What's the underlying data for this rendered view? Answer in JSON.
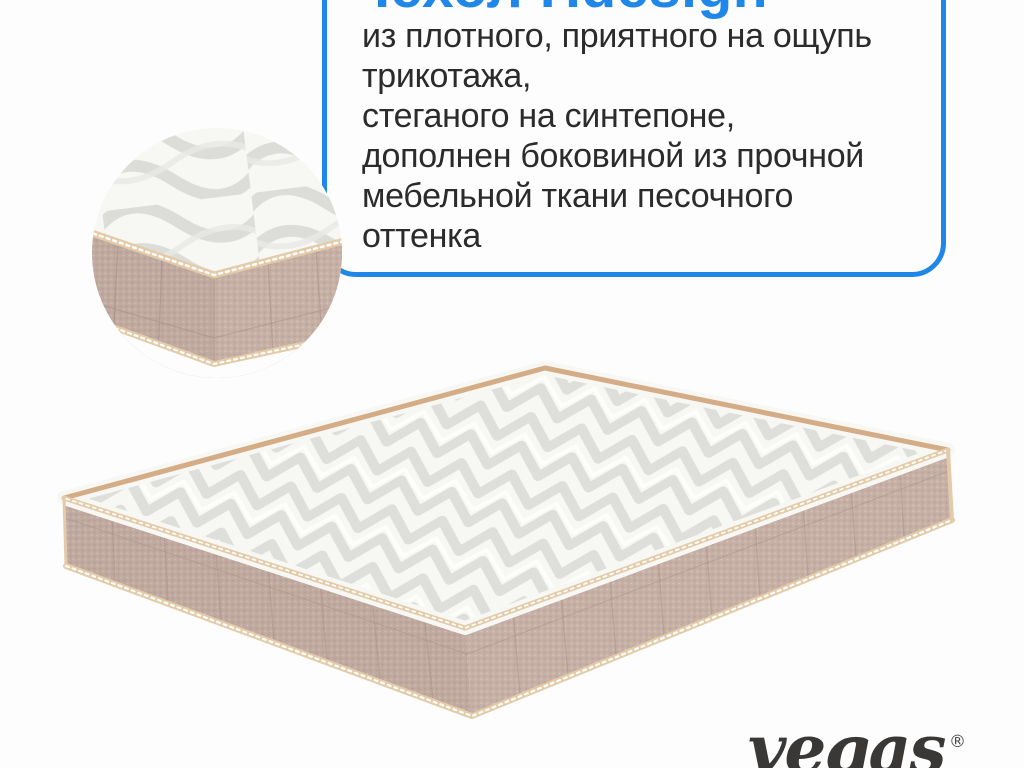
{
  "callout": {
    "title": "Чехол Hdesign",
    "lines": [
      "из плотного, приятного на ощупь",
      "трикотажа,",
      "стеганого на синтепоне,",
      "дополнен боковиной из прочной",
      "мебельной ткани песочного",
      "оттенка"
    ]
  },
  "brand": {
    "logo_text": "vegas",
    "registered_mark": "®"
  },
  "images": {
    "detail_circle": "mattress-corner-closeup",
    "main": "mattress-3d-perspective"
  },
  "colors": {
    "accent_blue": "#1e87e8",
    "text_dark": "#2b2b2b",
    "background": "#fdfdfd",
    "quilt_white": "#f7f7f4",
    "quilt_shadow": "#dadad6",
    "fabric_beige": "#c6afa5",
    "fabric_seam": "#ab9287",
    "piping_cream": "#e3cbaa",
    "piping_tan": "#d4ac85",
    "logo_dark": "#3a3836"
  }
}
